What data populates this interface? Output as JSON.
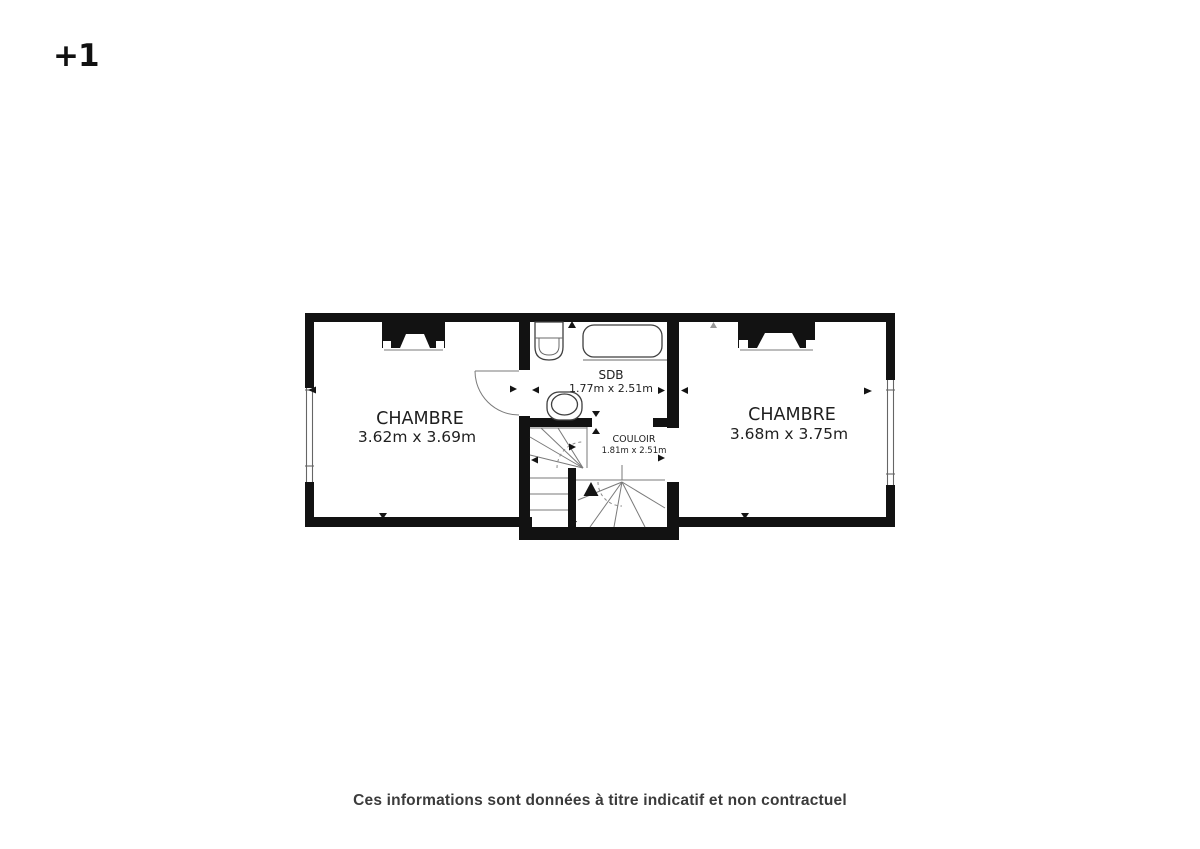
{
  "floor_indicator": "+1",
  "plan": {
    "rooms": [
      {
        "name": "CHAMBRE",
        "dimensions": "3.62m x 3.69m"
      },
      {
        "name": "SDB",
        "dimensions": "1.77m x 2.51m"
      },
      {
        "name": "COULOIR",
        "dimensions": "1.81m x 2.51m"
      },
      {
        "name": "CHAMBRE",
        "dimensions": "3.68m x 3.75m"
      }
    ],
    "fixtures": [
      "sink",
      "bathtub",
      "toilet",
      "stairs",
      "door",
      "chimney-left",
      "chimney-right",
      "window-left",
      "window-right"
    ]
  },
  "disclaimer": "Ces informations sont données à titre indicatif et non contractuel",
  "colors": {
    "wall": "#121212",
    "thin_line": "#666666",
    "text": "#1f1f1f",
    "disclaimer_text": "#3b3b3b",
    "background": "#ffffff"
  }
}
